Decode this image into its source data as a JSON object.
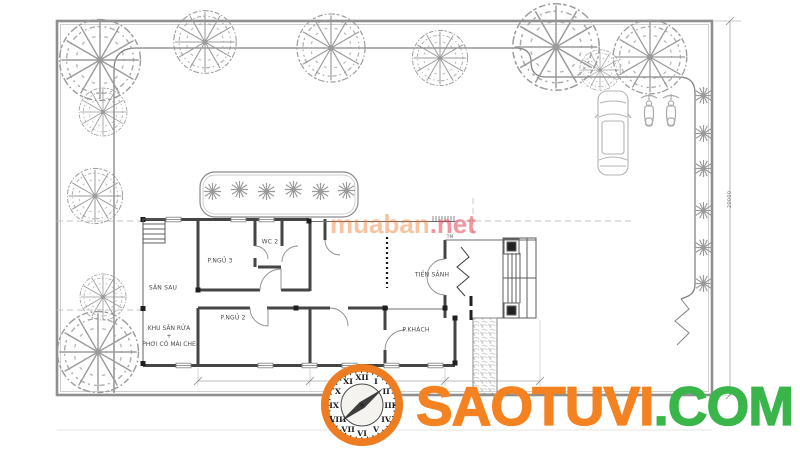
{
  "branding": {
    "watermark_name": "muaban",
    "watermark_tld": ".net",
    "logo_brand": "SAOTUVI",
    "logo_tld": ".COM",
    "clock_numerals": [
      "XII",
      "I",
      "II",
      "III",
      "IV",
      "V",
      "VI",
      "VII",
      "VIII",
      "IX",
      "X",
      "XI"
    ]
  },
  "floor_plan": {
    "rooms": {
      "san_sau": "SÂN SAU",
      "p_ngu_3": "P.NGỦ 3",
      "wc_2": "WC 2",
      "p_ngu_2": "P.NGỦ 2",
      "khu_san_rua": "KHU SÂN RỬA",
      "khu_san_rua_plus": "+",
      "phoi_co_mai_che": "PHƠI CÓ MÁI CHE",
      "tien_sanh": "TIỀN SẢNH",
      "p_khach": "P.KHÁCH",
      "entry_note": "TM"
    },
    "dimensions": {
      "right_boundary": "20000"
    }
  },
  "colors": {
    "logo_orange": "#F58220",
    "logo_green": "#3AB54A",
    "watermark_orange": "#F07121",
    "watermark_red": "#E83E50",
    "wall_dark": "#454545",
    "boundary_grey": "#8F8F8F"
  }
}
